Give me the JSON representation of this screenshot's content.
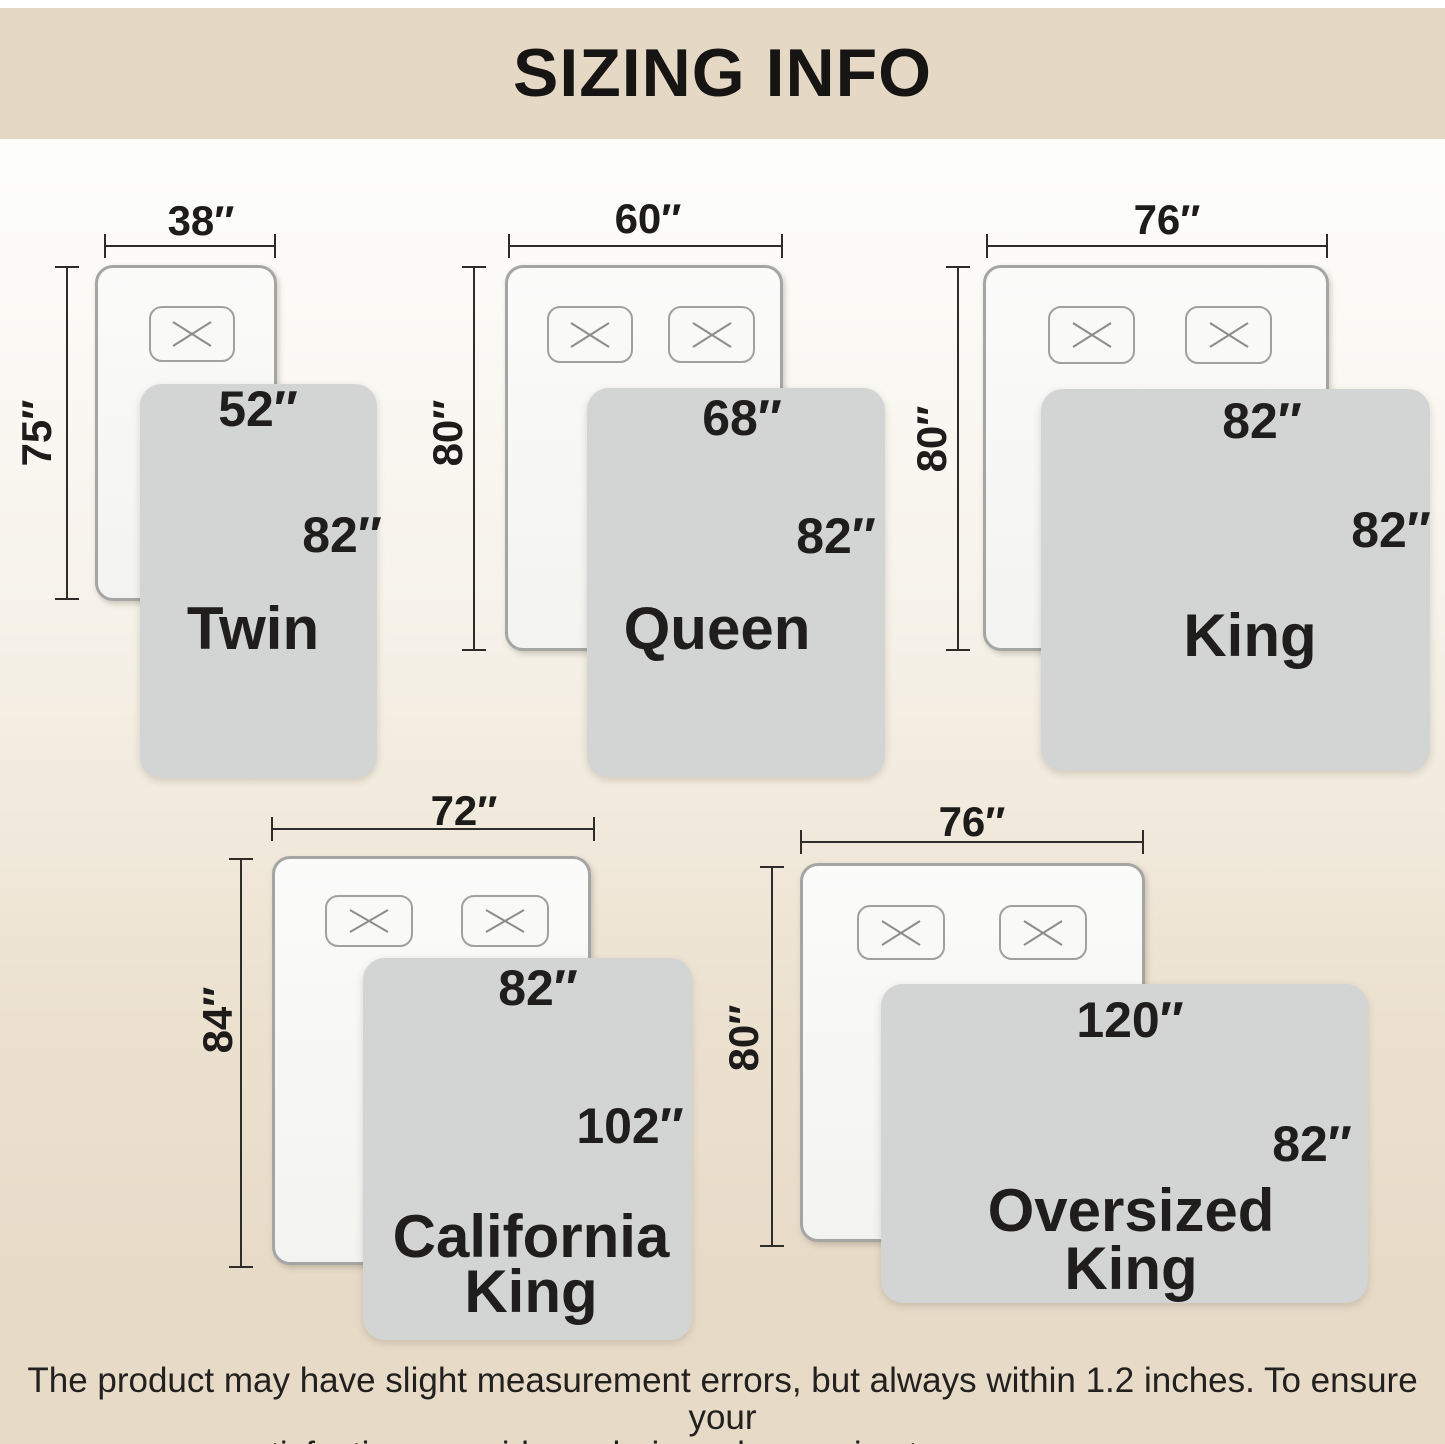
{
  "title": "SIZING INFO",
  "disclaimer": {
    "line1": "The product may have slight measurement errors, but always within 1.2 inches. To ensure your",
    "line2": "satisfaction, consider ordering a larger size to cover more area."
  },
  "colors": {
    "header_background": "#e5d9c6",
    "page_gradient_top": "#fdfdfb",
    "page_gradient_bottom": "#e7dbc8",
    "bed_fill": "#f8f8f7",
    "bed_border": "#a5a5a3",
    "blanket_fill": "#d3d4d4",
    "dimension_line": "#2e2c29",
    "text": "#1f1e1c"
  },
  "diagrams": [
    {
      "id": "twin",
      "name_lines": [
        "Twin"
      ],
      "bed_width": "38″",
      "bed_length": "75″",
      "blanket_width": "52″",
      "blanket_length": "82″",
      "pillow_count": 1
    },
    {
      "id": "queen",
      "name_lines": [
        "Queen"
      ],
      "bed_width": "60″",
      "bed_length": "80″",
      "blanket_width": "68″",
      "blanket_length": "82″",
      "pillow_count": 2
    },
    {
      "id": "king",
      "name_lines": [
        "King"
      ],
      "bed_width": "76″",
      "bed_length": "80″",
      "blanket_width": "82″",
      "blanket_length": "82″",
      "pillow_count": 2
    },
    {
      "id": "california-king",
      "name_lines": [
        "California",
        "King"
      ],
      "bed_width": "72″",
      "bed_length": "84″",
      "blanket_width": "82″",
      "blanket_length": "102″",
      "pillow_count": 2
    },
    {
      "id": "oversized-king",
      "name_lines": [
        "Oversized",
        "King"
      ],
      "bed_width": "76″",
      "bed_length": "80″",
      "blanket_width": "120″",
      "blanket_length": "82″",
      "pillow_count": 2
    }
  ]
}
